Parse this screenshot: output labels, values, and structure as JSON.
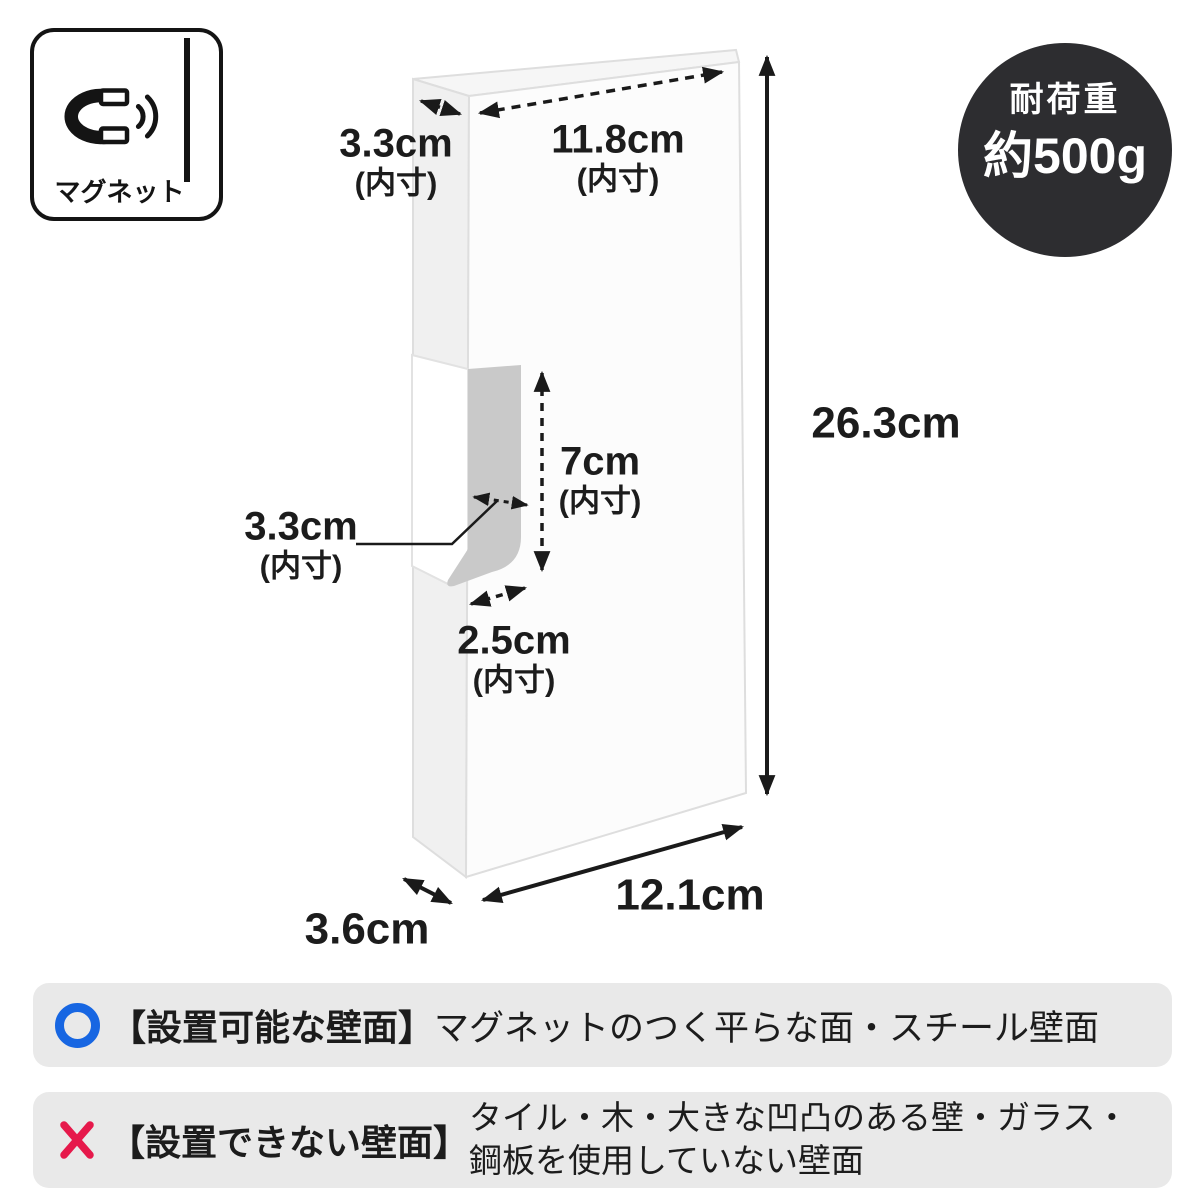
{
  "magnet_badge": {
    "label": "マグネット",
    "icon": "magnet-with-wall-icon"
  },
  "load_badge": {
    "title": "耐荷重",
    "value": "約500g"
  },
  "dimensions": {
    "top_depth": {
      "value": "3.3cm",
      "note": "(内寸)"
    },
    "top_width": {
      "value": "11.8cm",
      "note": "(内寸)"
    },
    "height": {
      "value": "26.3cm"
    },
    "slot_height": {
      "value": "7cm",
      "note": "(内寸)"
    },
    "slot_depth": {
      "value": "3.3cm",
      "note": "(内寸)"
    },
    "slot_width": {
      "value": "2.5cm",
      "note": "(内寸)"
    },
    "bottom_width": {
      "value": "12.1cm"
    },
    "bottom_depth": {
      "value": "3.6cm"
    }
  },
  "compatibility": {
    "ok": {
      "icon": "circle-ok-icon",
      "heading": "【設置可能な壁面】",
      "text": "マグネットのつく平らな面・スチール壁面"
    },
    "ng": {
      "icon": "cross-ng-icon",
      "heading": "【設置できない壁面】",
      "line1": "タイル・木・大きな凹凸のある壁・ガラス・",
      "line2": "鋼板を使用していない壁面"
    }
  },
  "colors": {
    "accent_blue": "#1766e2",
    "accent_red": "#e6194b",
    "badge_bg": "#2d2d30",
    "bar_bg": "#e9e9e9",
    "notch_gray": "#c9c9c9",
    "line_black": "#1a1a1a"
  }
}
